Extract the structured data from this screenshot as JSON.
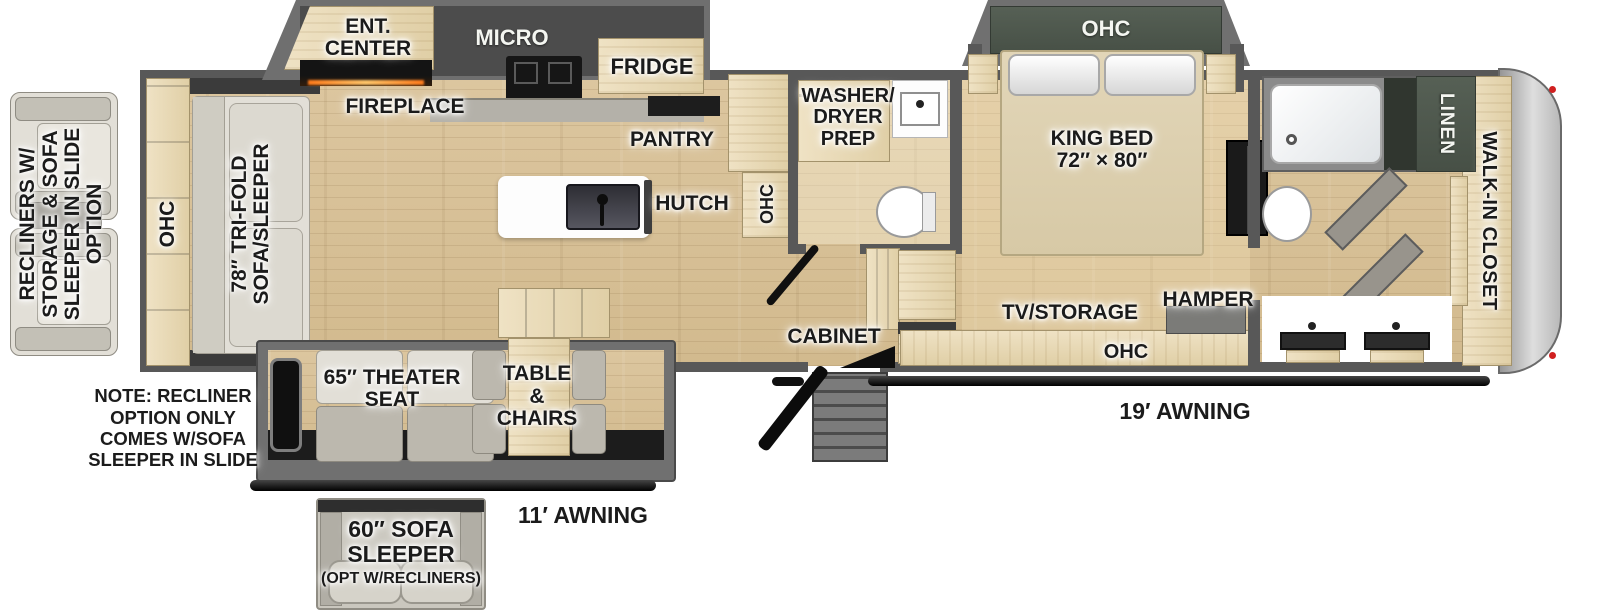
{
  "labels": {
    "option_recliners": "RECLINERS W/\nSTORAGE & SOFA\nSLEEPER IN SLIDE\nOPTION",
    "rear_ohc": "OHC",
    "trifold_sofa": "78″ TRI-FOLD\nSOFA/SLEEPER",
    "ent_center": "ENT.\nCENTER",
    "fireplace": "FIREPLACE",
    "micro": "MICRO",
    "fridge": "FRIDGE",
    "pantry": "PANTRY",
    "kitchen_ohc": "OHC",
    "hutch": "HUTCH",
    "washer_dryer_prep": "WASHER/\nDRYER\nPREP",
    "king_bed": "KING BED\n72″ × 80″",
    "bedroom_ohc": "OHC",
    "tv_storage": "TV/STORAGE",
    "hamper": "HAMPER",
    "lower_ohc": "OHC",
    "cabinet": "CABINET",
    "linen": "LINEN",
    "walk_in_closet": "WALK-IN CLOSET",
    "awning_19": "19′ AWNING",
    "awning_11": "11′ AWNING",
    "theater_seat": "65″ THEATER\nSEAT",
    "table_chairs": "TABLE\n&\nCHAIRS",
    "recliner_note": "NOTE: RECLINER\nOPTION ONLY\nCOMES W/SOFA\nSLEEPER IN SLIDE",
    "sofa_option": "60″ SOFA\nSLEEPER",
    "sofa_option_sub": "(OPT W/RECLINERS)"
  },
  "colors": {
    "floor_wood": "#d8c29b",
    "cabinet_wood": "#e8d9b8",
    "wall_gray": "#585858",
    "slide_gray": "#707070",
    "ohc_green": "#4d564c",
    "appliance_black": "#161616",
    "awning_black": "#0c0c0c",
    "label_text": "#1b1b1b"
  }
}
